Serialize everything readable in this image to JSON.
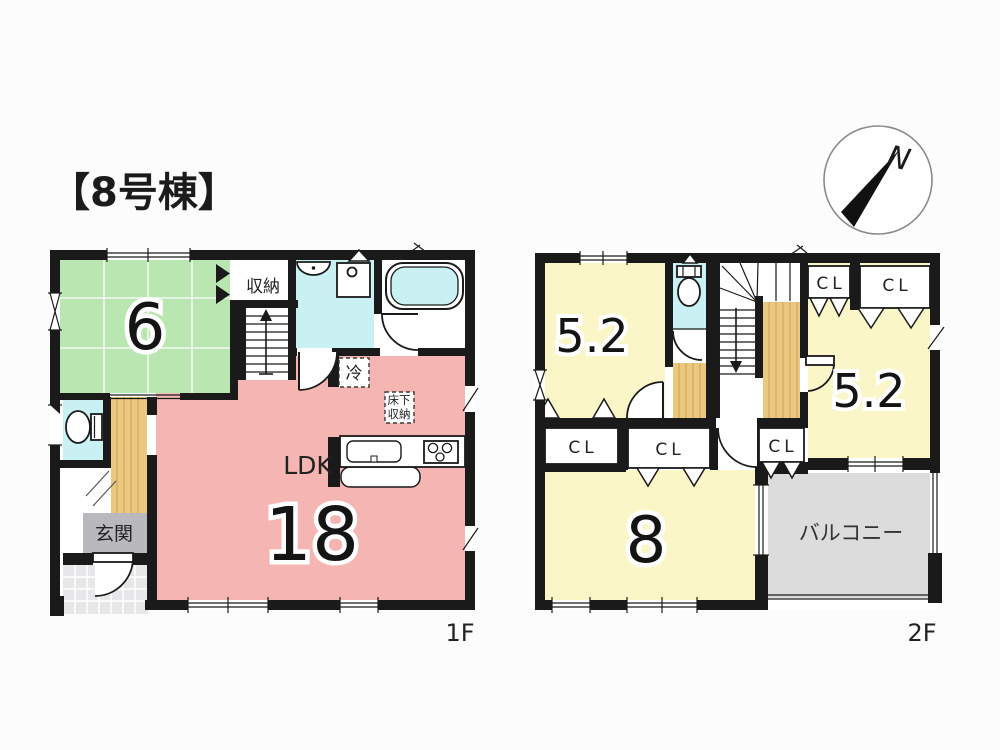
{
  "title": "【8号棟】",
  "compass": {
    "north": "N"
  },
  "colors": {
    "tatami": "#b9e6b1",
    "ldk": "#f5b5b2",
    "bedroom": "#fbf6c8",
    "wet_area": "#c9f0f2",
    "wood_floor": "#eac87f",
    "genkan": "#b9b9bd",
    "balcony": "#dcdcdc",
    "porch_tile": "#e7e7e9",
    "wall": "#1a1a1a"
  },
  "floor1": {
    "label": "1F",
    "tatami_size": "6",
    "storage": "収納",
    "ldk": "LDK",
    "ldk_size": "18",
    "fridge": "冷",
    "underfloor_line1": "床下",
    "underfloor_line2": "収納",
    "entrance": "玄関"
  },
  "floor2": {
    "label": "2F",
    "bedroom_nw_size": "5.2",
    "bedroom_e_size": "5.2",
    "bedroom_s_size": "8",
    "balcony": "バルコニー",
    "closets": [
      {
        "label": "CL"
      },
      {
        "label": "CL"
      },
      {
        "label": "CL"
      },
      {
        "label": "CL"
      },
      {
        "label": "CL"
      }
    ]
  }
}
